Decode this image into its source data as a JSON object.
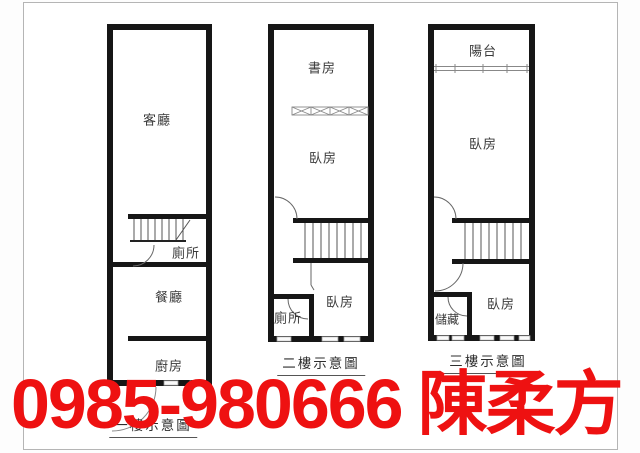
{
  "overlay": {
    "phone": "0985-980666",
    "agent": "陳柔方",
    "color": "#ee1111"
  },
  "plans": [
    {
      "caption": "一樓示意圖",
      "rooms": [
        {
          "label": "客廳"
        },
        {
          "label": "廁所"
        },
        {
          "label": "餐廳"
        },
        {
          "label": "廚房"
        }
      ]
    },
    {
      "caption": "二樓示意圖",
      "rooms": [
        {
          "label": "書房"
        },
        {
          "label": "臥房"
        },
        {
          "label": "臥房"
        },
        {
          "label": "廁所"
        }
      ]
    },
    {
      "caption": "三樓示意圖",
      "rooms": [
        {
          "label": "陽台"
        },
        {
          "label": "臥房"
        },
        {
          "label": "臥房"
        },
        {
          "label": "儲藏"
        }
      ]
    }
  ]
}
